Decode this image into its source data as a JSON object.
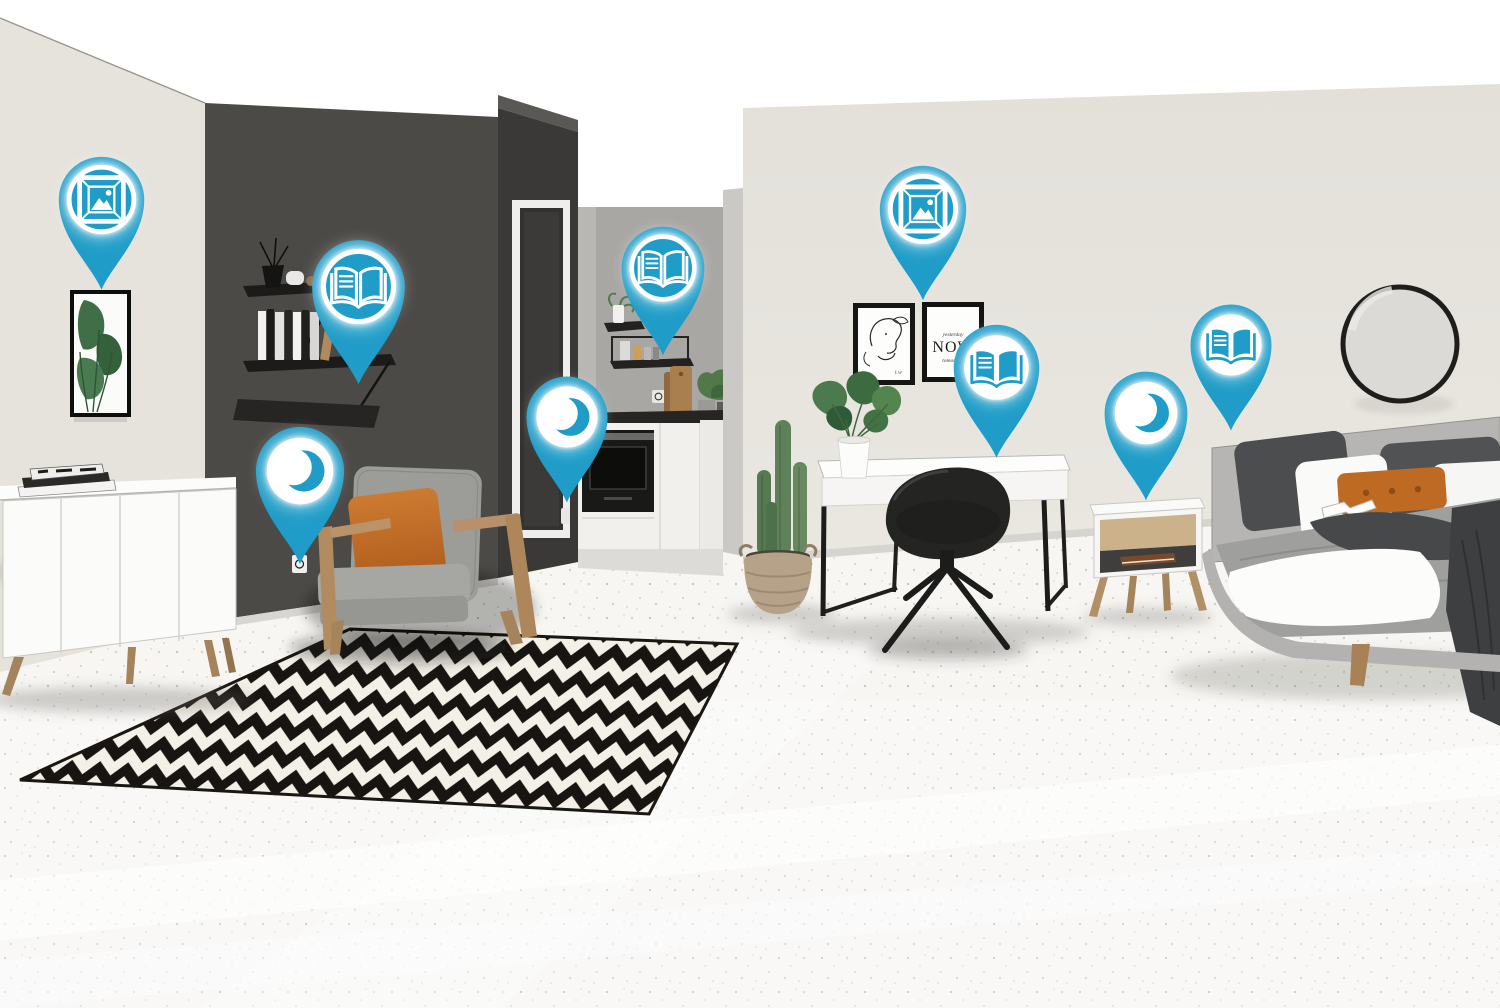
{
  "colors": {
    "pin_accent": "#1f9dc8",
    "wall_light": "#e6e3dd",
    "wall_dark": "#4b4a47",
    "cube_dark": "#3a3937",
    "kitchen_wall": "#a9a7a4",
    "floor": "#f7f6f3",
    "rug_black": "#171411",
    "rug_cream": "#f3f0e7",
    "accent_orange": "#c06a24",
    "wood": "#b28b60"
  },
  "posters": {
    "now_top": "yesterday",
    "now_main": "NOW",
    "now_bottom": "tomorrow"
  },
  "pins": [
    {
      "id": "picture-living",
      "icon": "picture",
      "style": "teal",
      "x": 101,
      "y": 292,
      "size": 95
    },
    {
      "id": "reading-shelf",
      "icon": "book",
      "style": "teal",
      "x": 358,
      "y": 386,
      "size": 103
    },
    {
      "id": "night-armchair",
      "icon": "moon",
      "style": "white",
      "x": 300,
      "y": 566,
      "size": 98
    },
    {
      "id": "reading-kitchen",
      "icon": "book",
      "style": "teal",
      "x": 663,
      "y": 357,
      "size": 92
    },
    {
      "id": "night-kitchen",
      "icon": "moon",
      "style": "white",
      "x": 567,
      "y": 504,
      "size": 90
    },
    {
      "id": "picture-bedroom",
      "icon": "picture",
      "style": "teal",
      "x": 923,
      "y": 302,
      "size": 96
    },
    {
      "id": "reading-desk",
      "icon": "book",
      "style": "white",
      "x": 996,
      "y": 460,
      "size": 95
    },
    {
      "id": "night-nightstand",
      "icon": "moon",
      "style": "white",
      "x": 1146,
      "y": 502,
      "size": 92
    },
    {
      "id": "reading-bed",
      "icon": "book",
      "style": "white",
      "x": 1231,
      "y": 432,
      "size": 90
    }
  ]
}
